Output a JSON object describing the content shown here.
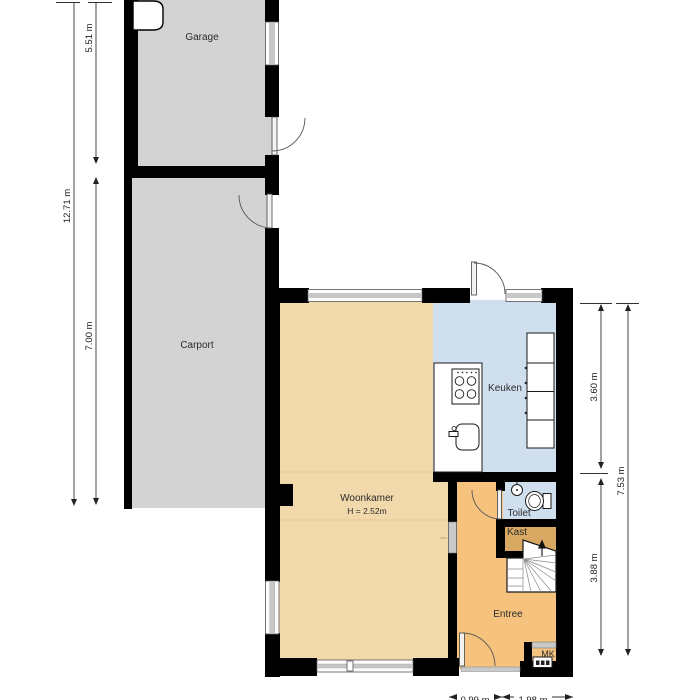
{
  "plan": {
    "title": "Ground floor plan (Dutch dwelling with garage and carport)",
    "rooms": {
      "garage": {
        "label": "Garage"
      },
      "carport": {
        "label": "Carport"
      },
      "woonkamer": {
        "label": "Woonkamer",
        "sublabel": "H = 2.52m"
      },
      "keuken": {
        "label": "Keuken"
      },
      "toilet": {
        "label": "Toilet"
      },
      "kast": {
        "label": "Kast"
      },
      "entree": {
        "label": "Entree"
      },
      "mk": {
        "label": "MK"
      }
    },
    "dimensions": {
      "left_total": "12.71 m",
      "garage_depth": "5.51 m",
      "carport_depth": "7.00 m",
      "kitchen_side": "3.60 m",
      "entry_side": "3.88 m",
      "right_total": "7.53 m",
      "bottom_a": "0.99 m",
      "bottom_b": "1.98 m"
    },
    "colors": {
      "wall": "#000000",
      "garage_carport_fill": "#d3d3d3",
      "living_fill": "#f2d9ab",
      "hall_fill": "#f5c37e",
      "closet_fill": "#d9a963",
      "kitchen_toilet_fill": "#cfdfee",
      "window_fill": "#c8c8c8",
      "outside": "#ffffff"
    }
  }
}
